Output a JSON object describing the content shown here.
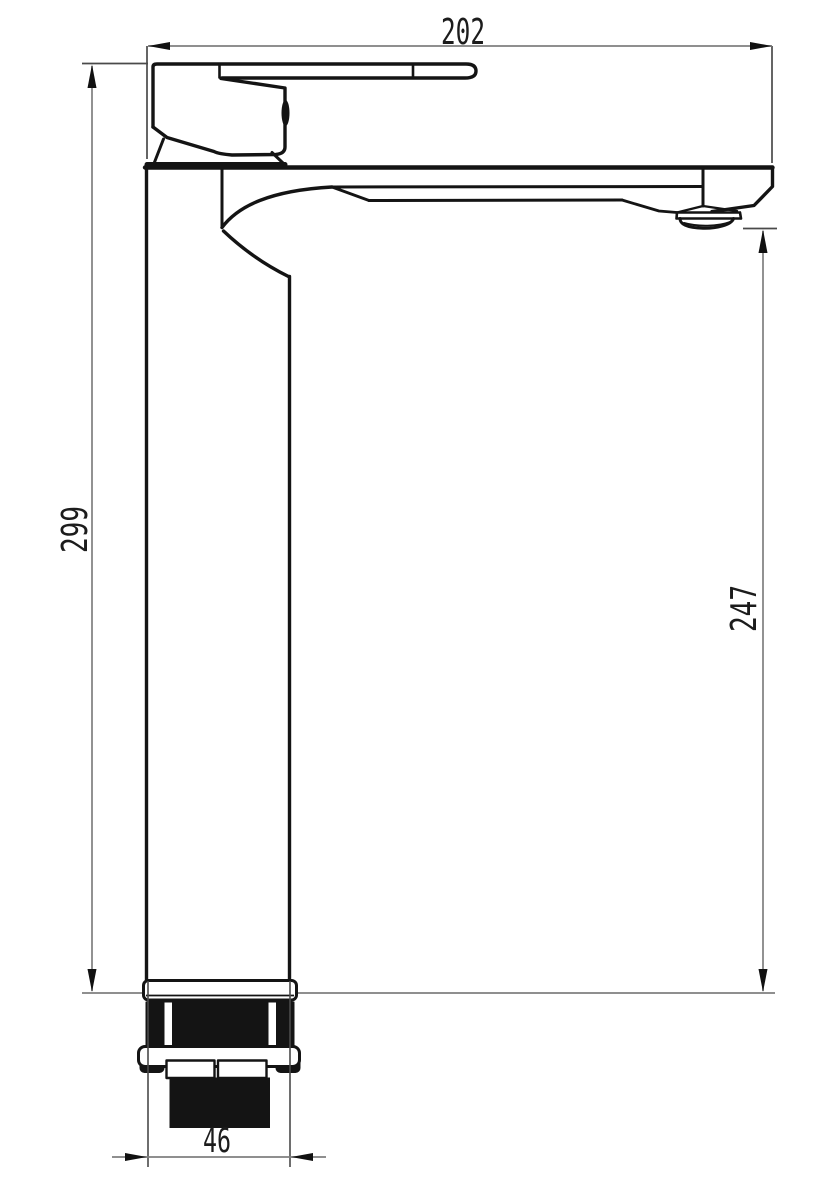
{
  "canvas": {
    "width": 816,
    "height": 1200,
    "background": "#ffffff"
  },
  "colors": {
    "outline": "#141414",
    "fill_dark": "#141414",
    "fill_white": "#ffffff",
    "dimension_line": "#7f7f7f",
    "extension_line": "#4a4a4a",
    "arrow": "#111111",
    "text": "#1c1c1c"
  },
  "dimensions": {
    "spout_reach": "202",
    "overall_height": "299",
    "outlet_height": "247",
    "body_diameter": "46"
  }
}
